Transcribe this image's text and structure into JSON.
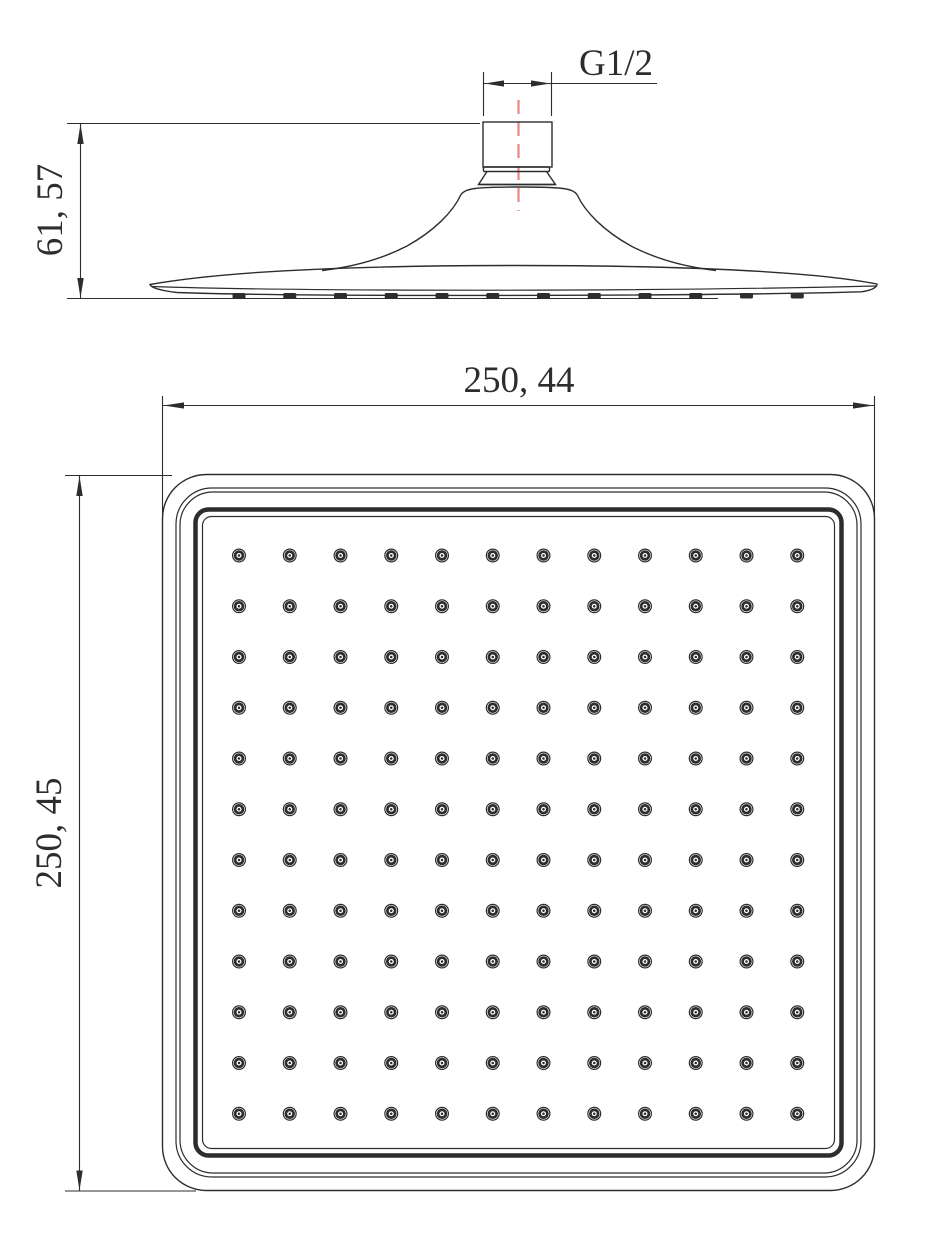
{
  "colors": {
    "line": "#2d2d2d",
    "centerline": "#ef8383",
    "background": "#ffffff"
  },
  "side_view": {
    "thread_label": "G1/2",
    "height_dim_label": "61, 57"
  },
  "plan_view": {
    "width_dim_label": "250, 44",
    "height_dim_label": "250, 45",
    "nozzle_rows": 12,
    "nozzle_cols": 12,
    "side_nozzle_count": 12
  }
}
